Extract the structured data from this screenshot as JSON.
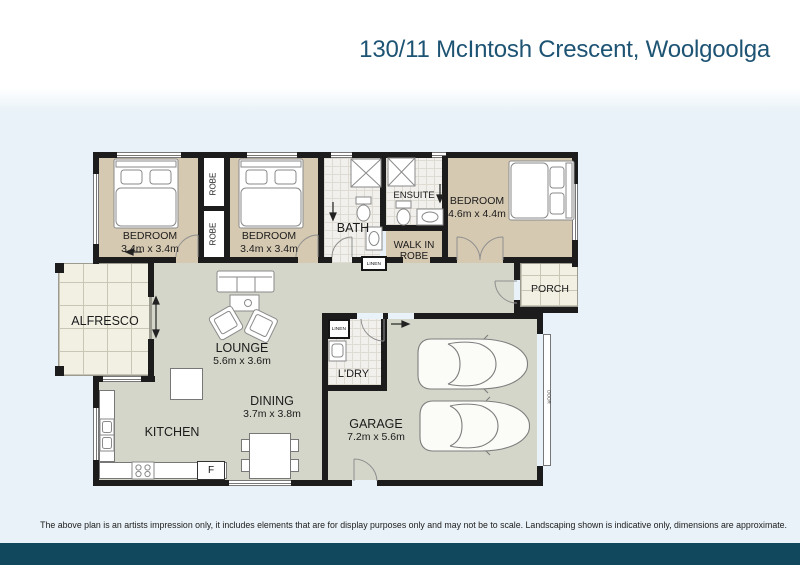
{
  "header": {
    "title": "130/11 McIntosh Crescent, Woolgoolga"
  },
  "rooms": {
    "bedroom1": {
      "name": "BEDROOM",
      "dims": "3.4m x 3.4m"
    },
    "bedroom2": {
      "name": "BEDROOM",
      "dims": "3.4m x 3.4m"
    },
    "bedroom3": {
      "name": "BEDROOM",
      "dims": "4.6m x 4.4m"
    },
    "bath": {
      "name": "BATH"
    },
    "ensuite": {
      "name": "ENSUITE"
    },
    "walk_in_robe": {
      "name": "WALK IN ROBE"
    },
    "robe1": {
      "name": "ROBE"
    },
    "robe2": {
      "name": "ROBE"
    },
    "linen_hall": {
      "name": "LINEN"
    },
    "linen_laundry": {
      "name": "LINEN"
    },
    "alfresco": {
      "name": "ALFRESCO"
    },
    "lounge": {
      "name": "LOUNGE",
      "dims": "5.6m x 3.6m"
    },
    "dining": {
      "name": "DINING",
      "dims": "3.7m x 3.8m"
    },
    "kitchen": {
      "name": "KITCHEN"
    },
    "laundry": {
      "name": "L'DRY"
    },
    "garage": {
      "name": "GARAGE",
      "dims": "7.2m x 5.6m"
    },
    "porch": {
      "name": "PORCH"
    },
    "fridge": {
      "name": "F"
    },
    "garage_door": {
      "name": "DOOR"
    }
  },
  "footer": {
    "disclaimer": "The above plan is an artists impression only, it includes elements that are for display purposes only and may not be to scale. Landscaping shown is indicative only, dimensions are approximate."
  },
  "colors": {
    "title": "#1d5373",
    "footer_bar": "#11485e",
    "page_tint": "#e9f2f8",
    "wall": "#1c1c1c",
    "bedroom_floor": "#d6c9b2",
    "living_floor": "#d4d6c9",
    "tile_floor": "#f1f0ec",
    "deck_floor": "#f2efe3"
  }
}
